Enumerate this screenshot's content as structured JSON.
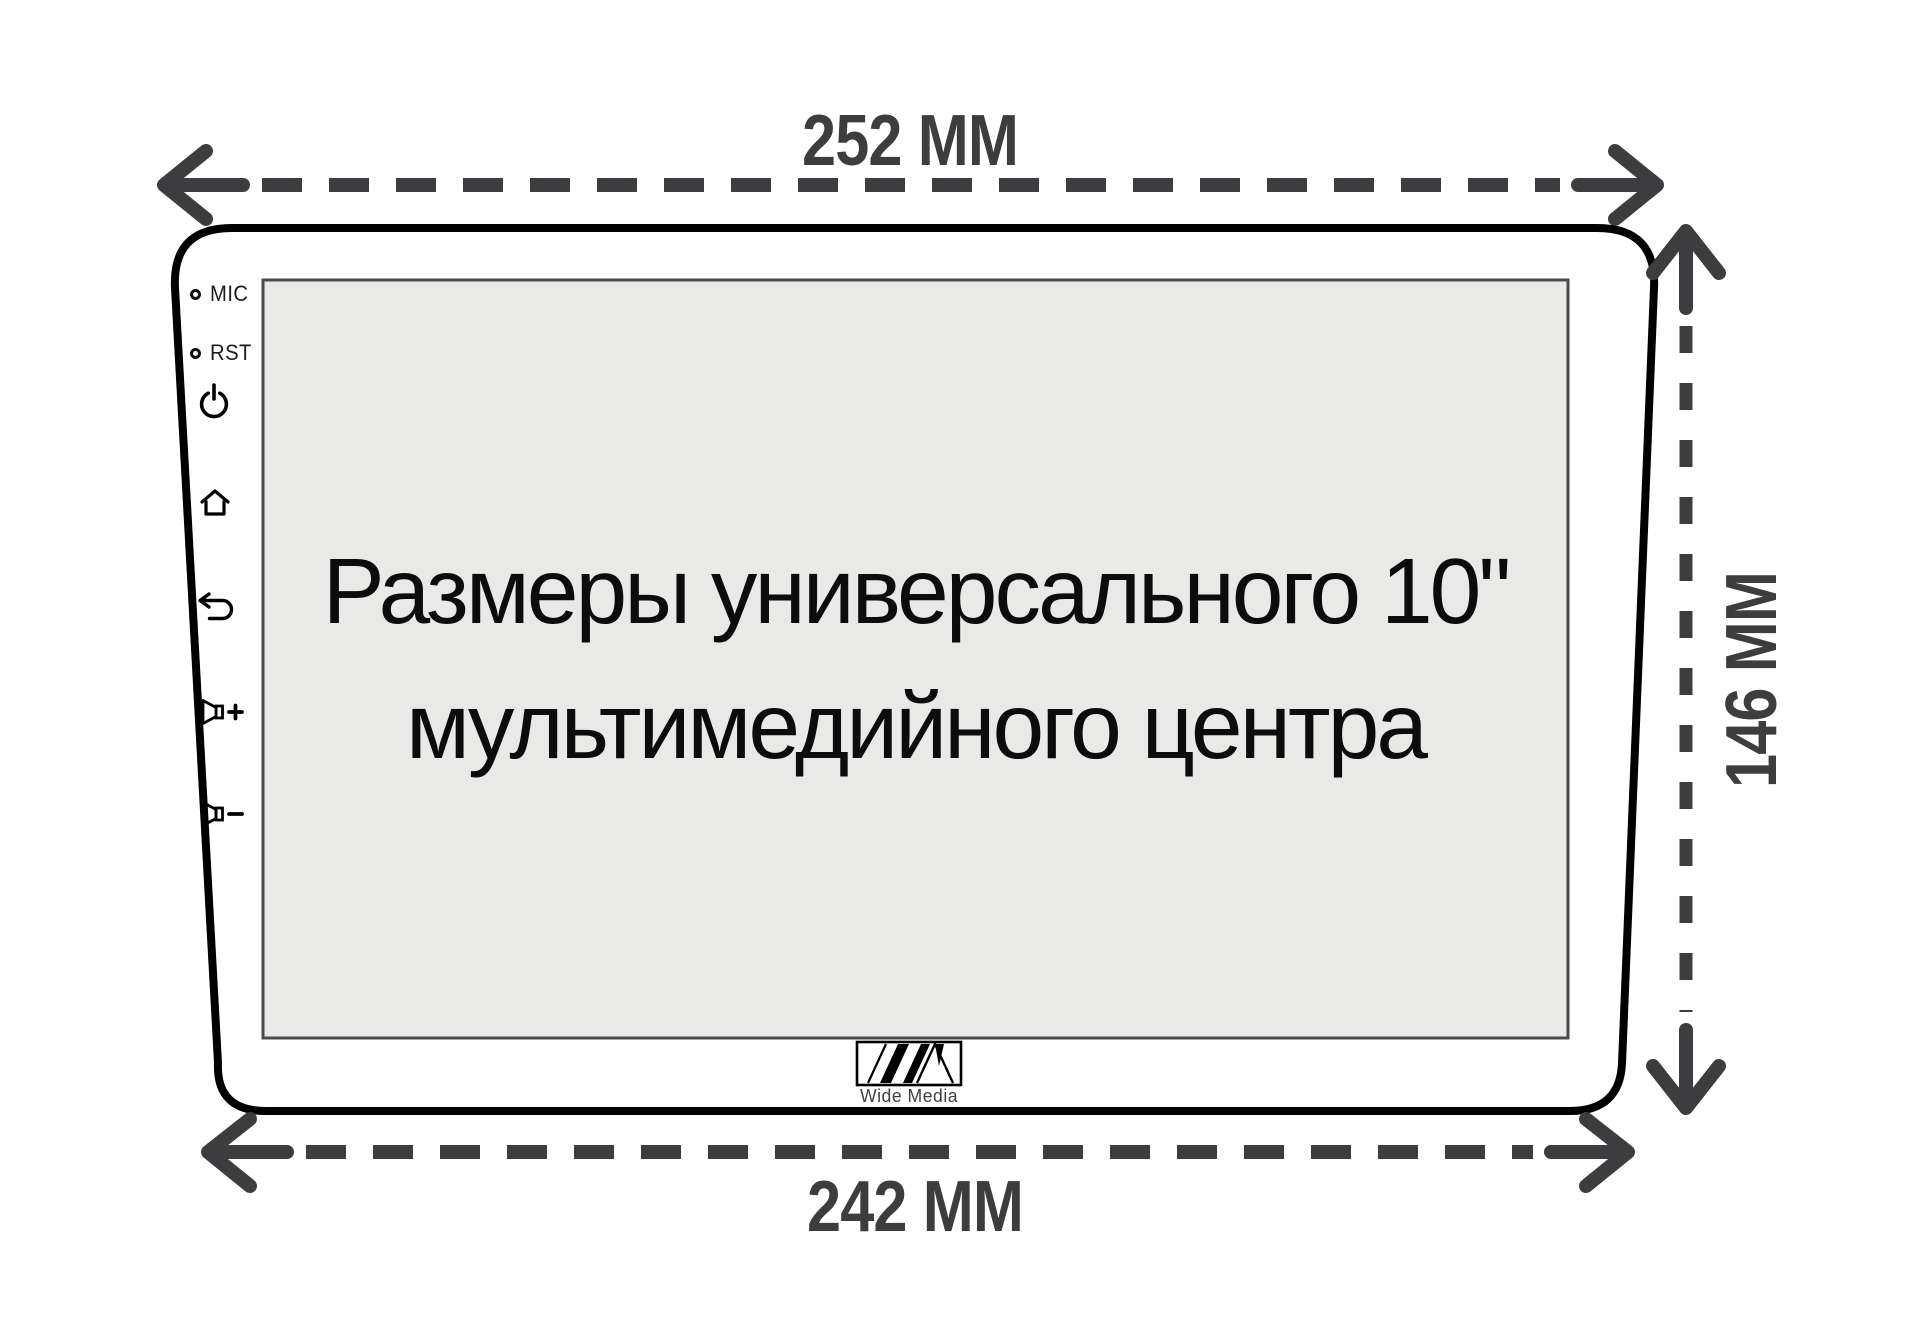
{
  "screen": {
    "caption_line1": "Размеры универсального 10\"",
    "caption_line2": "мультимедийного центра"
  },
  "dimensions": {
    "top_width": "252 MM",
    "bottom_width": "242 MM",
    "right_height": "146 MM"
  },
  "side_controls": {
    "mic_label": "MIC",
    "rst_label": "RST",
    "icons": {
      "power": "power-icon",
      "home": "home-icon",
      "back": "back-icon",
      "volume_up": "volume-up-icon",
      "volume_down": "volume-down-icon"
    }
  },
  "brand": {
    "logo_text": "Wide Media"
  },
  "colors": {
    "dimension_accent": "#3d3d3f",
    "device_outline": "#000000",
    "screen_fill": "#e9e9e8",
    "screen_border": "#4b4b4b",
    "background": "#ffffff"
  }
}
